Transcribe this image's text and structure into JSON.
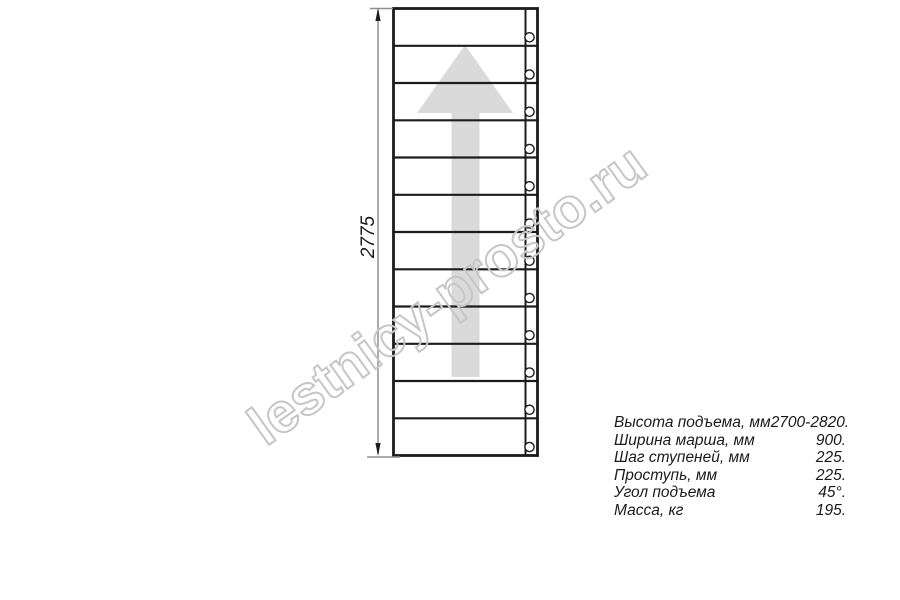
{
  "diagram": {
    "type": "staircase-plan-top-view",
    "dimension_label": "2775",
    "steps_count": 12,
    "arrow_direction": "up",
    "watermark": "lestnicy-prosto.ru",
    "colors": {
      "outline": "#1c1c1c",
      "dimension_line": "#909090",
      "arrow_fill": "#dadada",
      "watermark_stroke": "#c6c6c6",
      "text": "#1a1a1a"
    }
  },
  "specs": {
    "rows": [
      {
        "label": "Высота подъема, мм",
        "value": "2700-2820."
      },
      {
        "label": "Ширина марша, мм",
        "value": "900."
      },
      {
        "label": "Шаг ступеней, мм",
        "value": "225."
      },
      {
        "label": "Проступь, мм",
        "value": "225."
      },
      {
        "label": "Угол подъема",
        "value": "45°."
      },
      {
        "label": "Масса, кг",
        "value": "195."
      }
    ]
  }
}
